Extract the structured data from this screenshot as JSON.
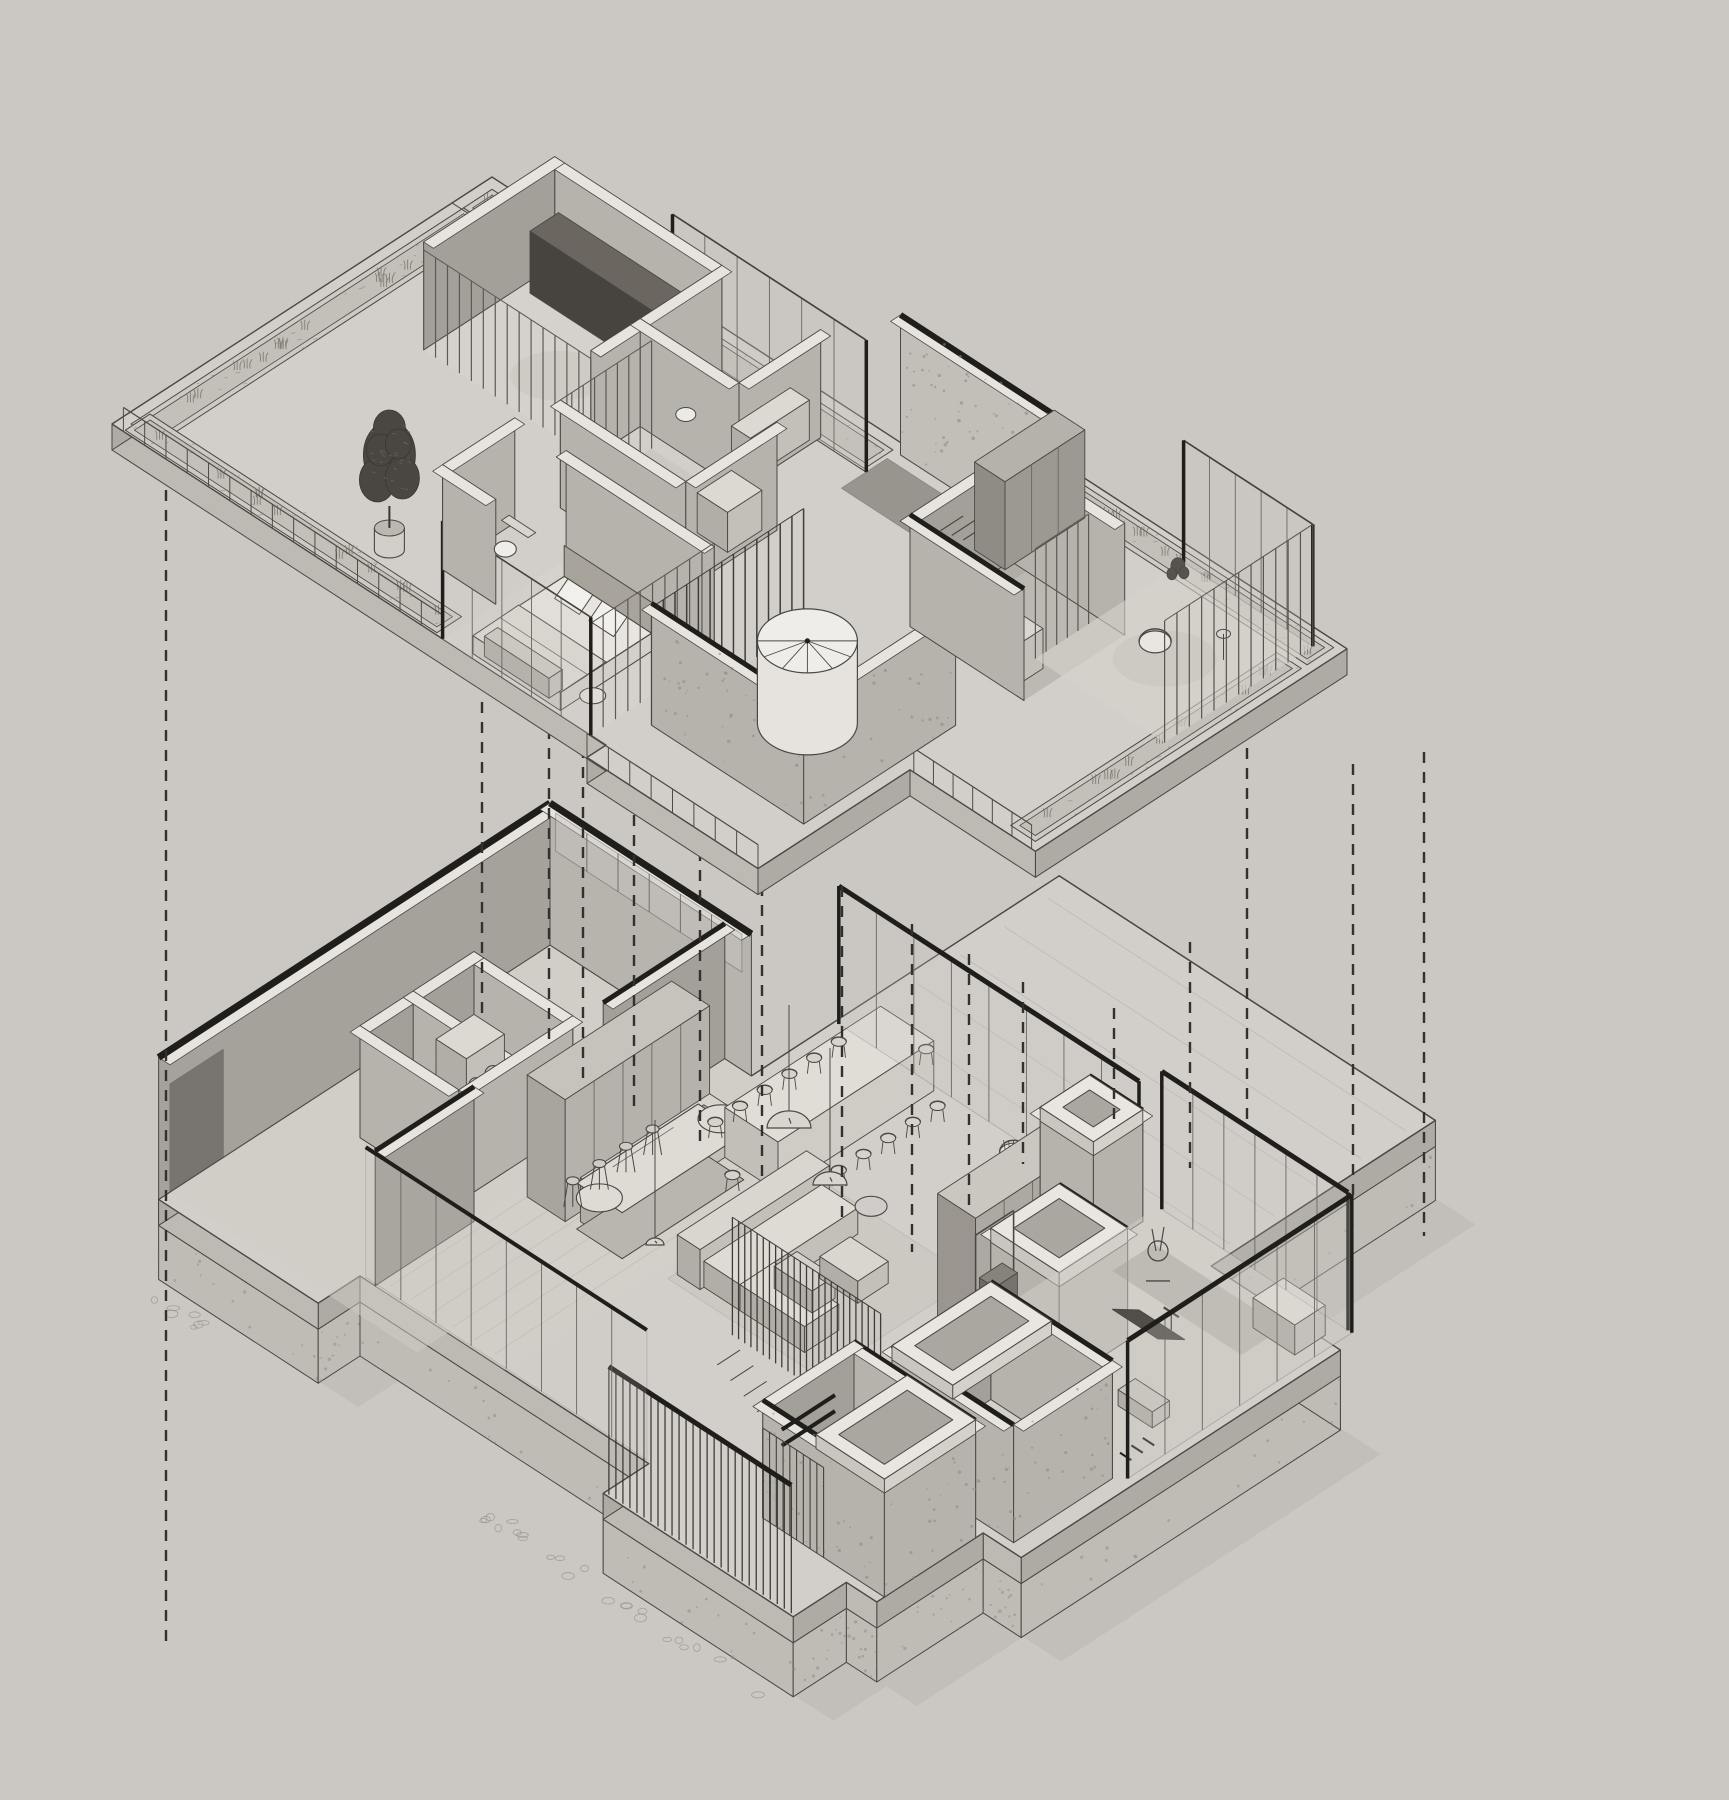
{
  "document": {
    "type": "architectural-exploded-axonometric-drawing",
    "storeys": 2
  },
  "palette": {
    "background": "#cbc7c2",
    "slab_top": "#d2cec9",
    "slab_side_a": "#bdb9b3",
    "slab_side_b": "#aeaaa4",
    "planter_rim": "#cdc9c3",
    "planter_soil": "#c3bfb9",
    "grass": "#77736d",
    "wall_face": "#b6b2ac",
    "wall_face_dark": "#a39f99",
    "wall_top": "#e7e4df",
    "floor_room": "#d6d3cd",
    "glass": "#c9c6c1",
    "dark_accent": "#201e1b",
    "line": "#4b4843",
    "line_soft": "#6b6762",
    "furniture": "#dcd9d3",
    "shadow": "#b2aea8",
    "dash_color": "#33312e",
    "speckle": "#8d8983"
  },
  "levels": [
    {
      "id": "upper-floor",
      "elements": [
        "roof-planters",
        "grass-tufts",
        "glass-railing",
        "terrace",
        "potted-tree",
        "dressing-room",
        "wardrobe-cabinet",
        "plant",
        "rug",
        "bathroom",
        "ensuite-bathroom",
        "toilet",
        "bedroom",
        "bed",
        "pillows",
        "bench",
        "curtain-louver-screens",
        "corridor-concrete-wall",
        "void-slot",
        "spiral-staircase",
        "double-vanity-bathroom",
        "vanity-mirrors",
        "sitting-room",
        "armchair",
        "side-table"
      ]
    },
    {
      "id": "lower-floor",
      "elements": [
        "stone-plinth",
        "pebble-ground",
        "garage",
        "concrete-walls",
        "roof-beams",
        "laundry-room",
        "washer-dryer",
        "powder-room",
        "kitchen-cabinets",
        "kitchen-counter",
        "kitchen-island",
        "bar-stools",
        "pendant-lamps",
        "dining-table",
        "dining-chairs",
        "sliding-glass-wall",
        "living-room",
        "rug",
        "sofa",
        "ottoman",
        "coffee-table",
        "wicker-lounge-chairs",
        "floor-lamp",
        "wardrobe-row",
        "louver-screen",
        "stair-down",
        "deck",
        "gym",
        "gym-glass-walls",
        "treadmill",
        "elliptical-trainer",
        "cable-station",
        "gym-bench",
        "bathroom-volumes",
        "skylight-rings",
        "towel-bars",
        "louver-facade"
      ]
    }
  ],
  "projection_lines": {
    "style": "dashed",
    "count": 16
  }
}
